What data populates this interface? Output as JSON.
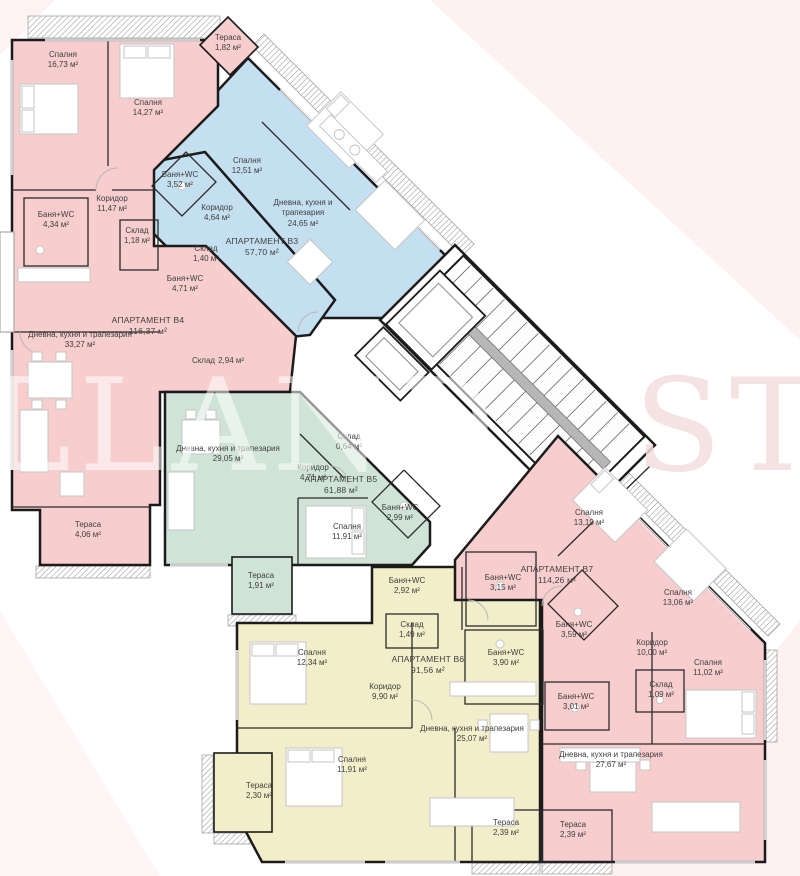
{
  "watermark": {
    "left": "LLAND",
    "right": "STA"
  },
  "colors": {
    "apartment_pink": "#f7cdcd",
    "apartment_blue": "#c3dff0",
    "apartment_green": "#cfe4d7",
    "apartment_yellow": "#f2eec9",
    "walls": "#1b1b1b",
    "label_text": "#3f3f3f"
  },
  "apartments": [
    {
      "id": "B3",
      "name": "АПАРТАМЕНТ В3",
      "area": "57,70 м²",
      "color": "#c3dff0",
      "rooms": [
        {
          "label": "Спалня",
          "area": "12,51 м²"
        },
        {
          "label": "Баня+WC",
          "area": "3,52 м²"
        },
        {
          "label": "Коридор",
          "area": "4,64 м²"
        },
        {
          "label": "Склад",
          "area": "1,40 м²"
        },
        {
          "label": "Дневна, кухня и трапезария",
          "area": "24,65 м²"
        },
        {
          "label": "Тераса",
          "area": "1,82 м²"
        }
      ]
    },
    {
      "id": "B4",
      "name": "АПАРТАМЕНТ В4",
      "area": "116,37 м²",
      "color": "#f7cdcd",
      "rooms": [
        {
          "label": "Спалня",
          "area": "16,73 м²"
        },
        {
          "label": "Спалня",
          "area": "14,27 м²"
        },
        {
          "label": "Коридор",
          "area": "11,47 м²"
        },
        {
          "label": "Баня+WC",
          "area": "4,34 м²"
        },
        {
          "label": "Склад",
          "area": "1,18 м²"
        },
        {
          "label": "Баня+WC",
          "area": "4,71 м²"
        },
        {
          "label": "Дневна, кухня и трапезария",
          "area": "33,27 м²"
        },
        {
          "label": "Склад",
          "area": "2,94 м²"
        },
        {
          "label": "Тераса",
          "area": "4,06 м²"
        }
      ]
    },
    {
      "id": "B5",
      "name": "АПАРТАМЕНТ В5",
      "area": "61,88 м²",
      "color": "#cfe4d7",
      "rooms": [
        {
          "label": "Дневна, кухня и трапезария",
          "area": "29,05 м²"
        },
        {
          "label": "Коридор",
          "area": "4,71 м²"
        },
        {
          "label": "Склад",
          "area": "0,64 м²"
        },
        {
          "label": "Спалня",
          "area": "11,91 м²"
        },
        {
          "label": "Баня+WC",
          "area": "2,99 м²"
        },
        {
          "label": "Тераса",
          "area": "1,91 м²"
        }
      ]
    },
    {
      "id": "B6",
      "name": "АПАРТАМЕНТ В6",
      "area": "91,56 м²",
      "color": "#f2eec9",
      "rooms": [
        {
          "label": "Спалня",
          "area": "12,34 м²"
        },
        {
          "label": "Коридор",
          "area": "9,90 м²"
        },
        {
          "label": "Спалня",
          "area": "11,91 м²"
        },
        {
          "label": "Дневна, кухня и трапезария",
          "area": "25,07 м²"
        },
        {
          "label": "Баня+WC",
          "area": "2,92 м²"
        },
        {
          "label": "Склад",
          "area": "1,49 м²"
        },
        {
          "label": "Баня+WC",
          "area": "3,90 м²"
        },
        {
          "label": "Тераса",
          "area": "2,30 м²"
        },
        {
          "label": "Тераса",
          "area": "2,39 м²"
        }
      ]
    },
    {
      "id": "B7",
      "name": "АПАРТАМЕНТ В7",
      "area": "114,26 м²",
      "color": "#f7cdcd",
      "rooms": [
        {
          "label": "Спалня",
          "area": "13,19 м²"
        },
        {
          "label": "Баня+WC",
          "area": "3,15 м²"
        },
        {
          "label": "Баня+WC",
          "area": "3,59 м²"
        },
        {
          "label": "Спалня",
          "area": "13,06 м²"
        },
        {
          "label": "Коридор",
          "area": "10,00 м²"
        },
        {
          "label": "Склад",
          "area": "1,09 м²"
        },
        {
          "label": "Спалня",
          "area": "11,02 м²"
        },
        {
          "label": "Баня+WC",
          "area": "3,01 м²"
        },
        {
          "label": "Дневна, кухня и трапезария",
          "area": "27,67 м²"
        },
        {
          "label": "Тераса",
          "area": "2,39 м²"
        }
      ]
    }
  ]
}
